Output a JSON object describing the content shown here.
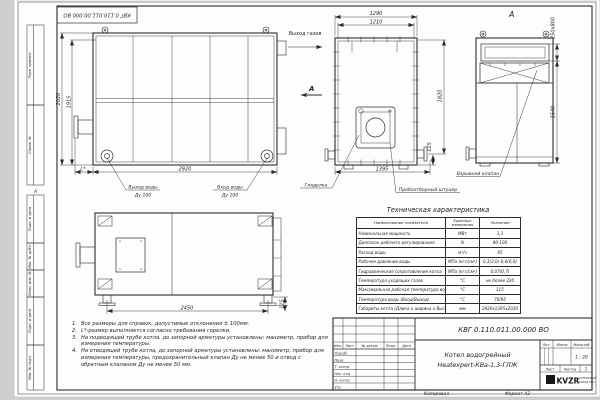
{
  "frame": {
    "designation_flipped": "КВГ 0.110.011.00.000 ВО",
    "zone_mark": "А",
    "left_boxes": [
      "Перв. примен.",
      "Справ. №",
      "Подп. и дата",
      "Инв. № дубл.",
      "Взам. инв. №",
      "Подп. и дата",
      "Инв. № подл."
    ],
    "footer": {
      "copied": "Копировал",
      "format": "Формат А3"
    }
  },
  "views": {
    "side": {
      "dim_height_outer": "2020",
      "dim_height_inner": "1915",
      "dim_width": "2920",
      "dim_l": "L*",
      "label_water_out": "Выход воды",
      "label_water_out_dn": "Ду 100",
      "label_water_in": "Вход воды",
      "label_water_in_dn": "Ду 100"
    },
    "front": {
      "dim_width_outer": "1290",
      "dim_width_inner": "1210",
      "dim_height": "1820",
      "dim_offset": "125",
      "dim_width_bottom": "1395",
      "label_gas_out": "Выход газов",
      "label_section": "А",
      "label_peephole": "Гляделка",
      "label_sampling": "Пробоотборный штуцер"
    },
    "section_a": {
      "title": "А",
      "dim_slot": "250х800",
      "dim_height": "1540",
      "label_valve": "Взрывной клапан"
    },
    "top": {
      "dim_width": "2450",
      "dim_offset": "115"
    }
  },
  "notes": {
    "items": [
      {
        "num": "1.",
        "text": "Все размеры для справок, допустимые отклонения ± 100мм."
      },
      {
        "num": "2.",
        "text": "L*-размер выполняется согласно требования горелки."
      },
      {
        "num": "3.",
        "text": "На подводящей трубе котла, до запорной арматуры установлены: манометр, прибор для измерения температуры."
      },
      {
        "num": "4.",
        "text": "На отводящей трубе котла, до запорной арматуры установлены: манометр, прибор для измерения температуры, предохранительный клапан Ду не менее 50 и отвод с обратным клапаном Ду не менее 50 мм."
      }
    ]
  },
  "spec_table": {
    "title": "Техническая характеристика",
    "headers": [
      "Наименование показателя",
      "Единицы измерения",
      "Значение"
    ],
    "rows": [
      [
        "Номинальная мощность",
        "МВт",
        "1,3"
      ],
      [
        "Диапазон рабочего регулирования",
        "%",
        "40-100"
      ],
      [
        "Расход воды",
        "м³/ч",
        "45"
      ],
      [
        "Рабочее давление воды",
        "МПа (кгс/см²)",
        "0,3(3,0)-0,6(6,0)"
      ],
      [
        "Гидравлическое сопротивление котла",
        "МПа (кгс/см²)",
        "0,07(0,7)"
      ],
      [
        "Температура уходящих газов",
        "°С",
        "не более 220"
      ],
      [
        "Максимальная рабочая температура воды",
        "°С",
        "115"
      ],
      [
        "Температура воды (Вход/Выход)",
        "°С",
        "70/95"
      ],
      [
        "Габариты котла (Длина х ширина х Высота)",
        "мм",
        "2920х1395х2020"
      ]
    ]
  },
  "title_block": {
    "designation": "КВГ 0.110.011.00.000 ВО",
    "product_name_1": "Котел водогрейный",
    "product_name_2": "Heatexpert-КВа-1,3-ГЛЖ",
    "header_cols": [
      "Изм.",
      "Лист",
      "№ докум.",
      "Подп.",
      "Дата"
    ],
    "sig_rows": [
      "Разраб.",
      "Пров.",
      "Т. контр.",
      "Нач. отд.",
      "Н. контр.",
      "Утв."
    ],
    "lit_label": "Лит.",
    "mass_label": "Масса",
    "scale_label": "Масштаб",
    "scale_value": "1 : 20",
    "sheet_label": "Лист",
    "sheets_label": "Листов",
    "sheets_value": "1",
    "logo_text": "KVZR",
    "org_line1": "КОТЕЛЬНЫЙ",
    "org_line2": "ЗАВОД РЭП"
  },
  "colors": {
    "line": "#2b2b2b",
    "sheet": "#fdfdfd",
    "backdrop": "#cfcfcf"
  }
}
